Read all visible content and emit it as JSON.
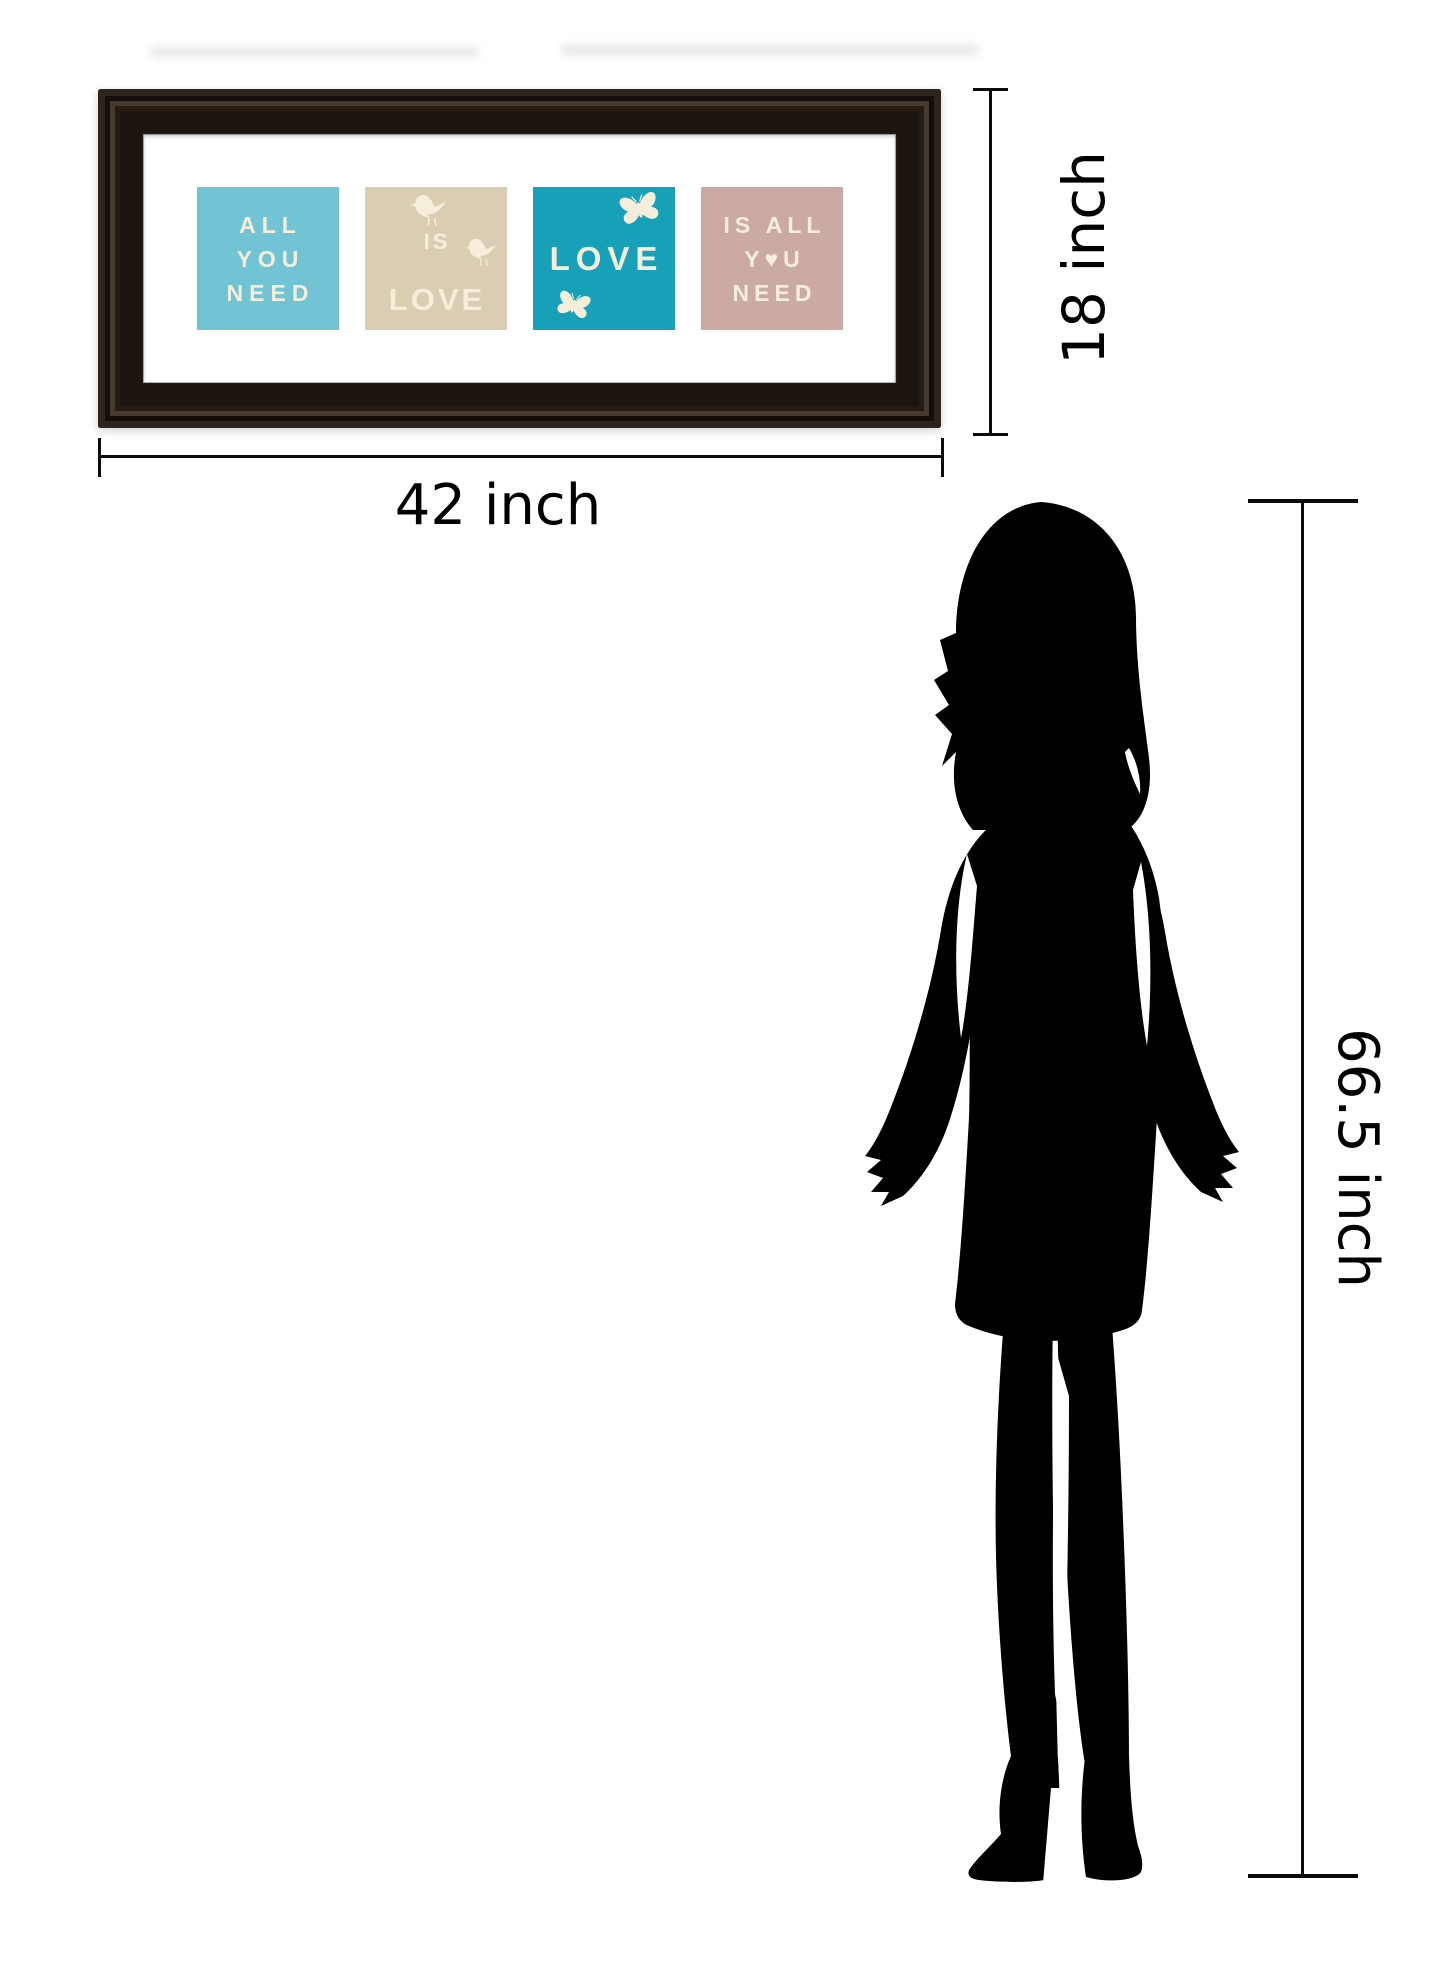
{
  "artwork": {
    "name": "All You Need Is Love framed wall art",
    "frame_color": "#241b15",
    "mat_color": "#ffffff",
    "text_color": "#f4eedb",
    "panels": [
      {
        "id": "panel-all-you-need",
        "bg": "#72c3d4",
        "lines": [
          "ALL",
          "YOU",
          "NEED"
        ],
        "icons": []
      },
      {
        "id": "panel-love-is",
        "bg": "#d9cdb2",
        "lines": [
          "IS",
          "LOVE"
        ],
        "icons": [
          "bird-icon",
          "bird-icon"
        ]
      },
      {
        "id": "panel-love",
        "bg": "#18a0b8",
        "lines": [
          "LOVE"
        ],
        "icons": [
          "butterfly-icon",
          "butterfly-icon"
        ]
      },
      {
        "id": "panel-is-all-you-need",
        "bg": "#cbaaa5",
        "lines": [
          "IS ALL",
          "Y♥U",
          "NEED"
        ],
        "icons": [
          "heart-icon"
        ]
      }
    ]
  },
  "dimensions": {
    "width_label": "42 inch",
    "height_label": "18 inch",
    "person_height_label": "66.5 inch",
    "line_color": "#0b0b0b"
  },
  "figure": {
    "type": "woman-silhouette",
    "color": "#000000"
  }
}
